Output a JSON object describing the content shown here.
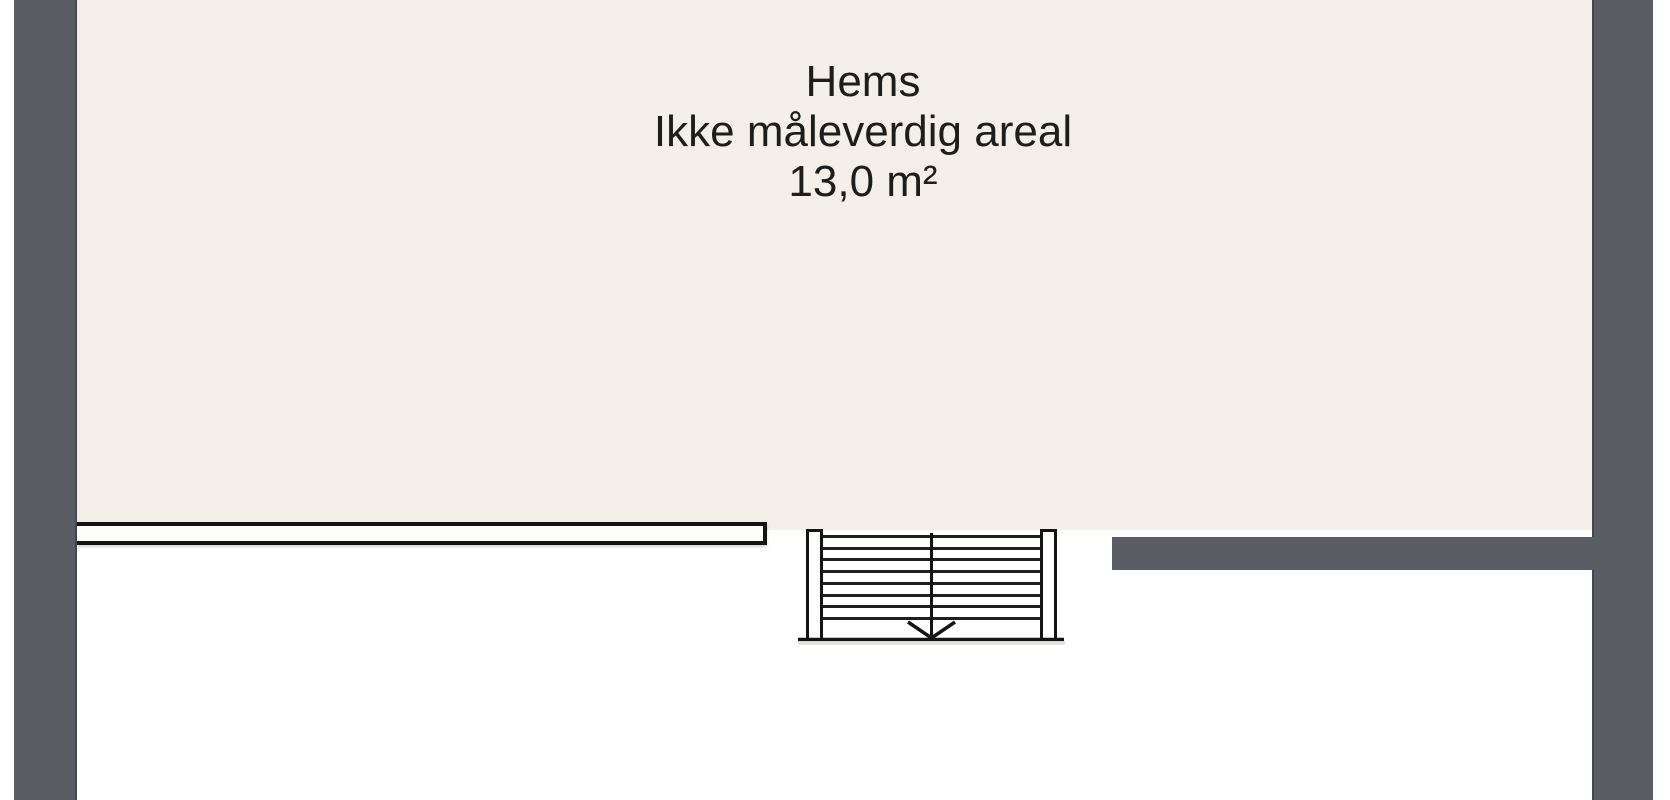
{
  "floorplan": {
    "room": {
      "name": "Hems",
      "note": "Ikke måleverdig areal",
      "area": "13,0 m²"
    },
    "staircase": {
      "step_lines": 8,
      "direction": "down"
    },
    "colors": {
      "wall": "#5a5d64",
      "floor": "#f4f0e9",
      "line": "#141414",
      "text": "#1d1d1b",
      "background": "#ffffff"
    }
  }
}
